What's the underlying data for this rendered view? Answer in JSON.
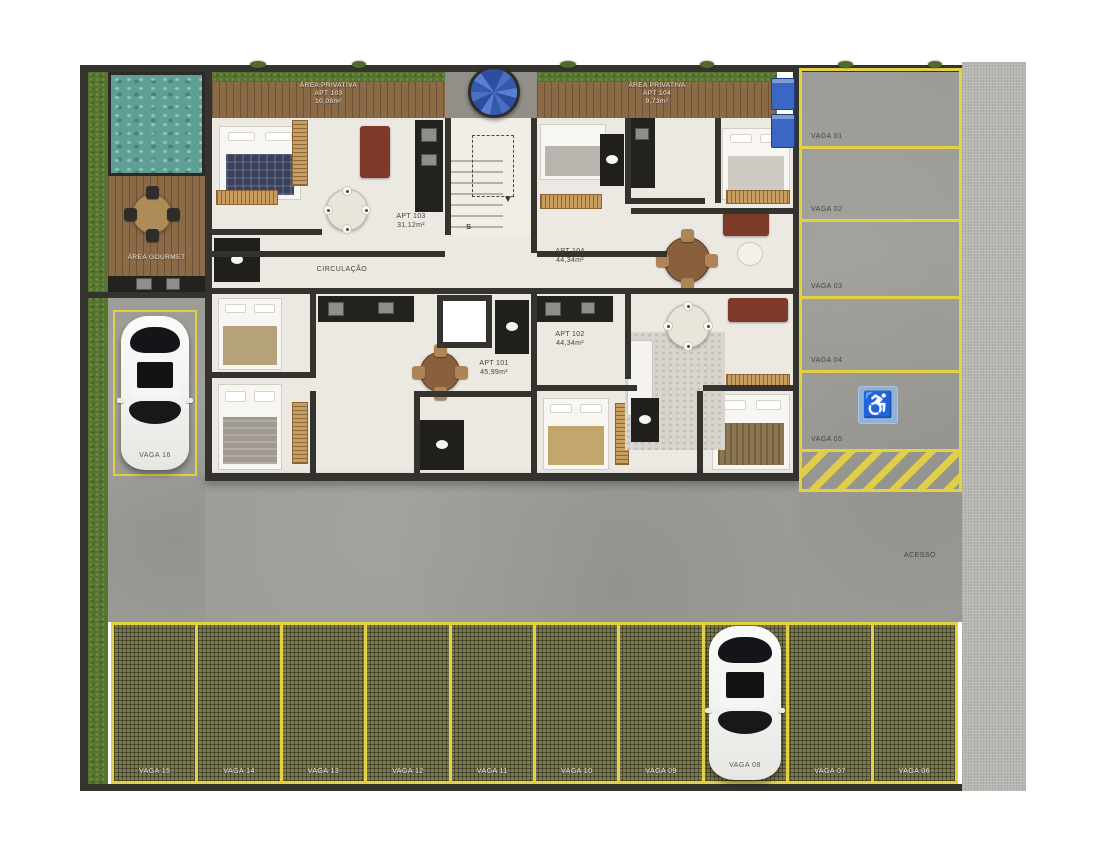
{
  "plan": {
    "gourmet_label": "ÁREA GOURMET",
    "circulation_label": "CIRCULAÇÃO",
    "access_label": "ACESSO",
    "stairs_label": "S"
  },
  "building": {
    "units": [
      {
        "name": "APT 101",
        "area": "45,99m²"
      },
      {
        "name": "APT 102",
        "area": "44,34m²"
      },
      {
        "name": "APT 103",
        "area": "31,12m²"
      },
      {
        "name": "APT 104",
        "area": "44,34m²"
      }
    ],
    "private_areas": [
      {
        "title": "ÁREA PRIVATIVA",
        "unit": "APT 103",
        "area": "10,08m²"
      },
      {
        "title": "ÁREA PRIVATIVA",
        "unit": "APT 104",
        "area": "9,73m²"
      }
    ]
  },
  "parking": {
    "right_column": [
      "VAGA 01",
      "VAGA 02",
      "VAGA 03",
      "VAGA 04",
      "VAGA 05"
    ],
    "left_spot": "VAGA 16",
    "bottom_row": [
      "VAGA 15",
      "VAGA 14",
      "VAGA 13",
      "VAGA 12",
      "VAGA 11",
      "VAGA 10",
      "VAGA 09",
      "VAGA 08",
      "VAGA 07",
      "VAGA 06"
    ]
  },
  "icons": {
    "accessible_parking": "♿",
    "stairs_down_arrow": "▼"
  },
  "colors": {
    "yellow_marking": "#E4D143",
    "grass": "#567331",
    "pool_water": "#5FA096",
    "deck_wood": "#8A6A47",
    "concrete": "#9D9C97",
    "gravel": "#B8B6B1",
    "grass_paver": "#7B7A4E",
    "wall": "#34332E",
    "accessibility_blue": "#8FB2D6"
  }
}
